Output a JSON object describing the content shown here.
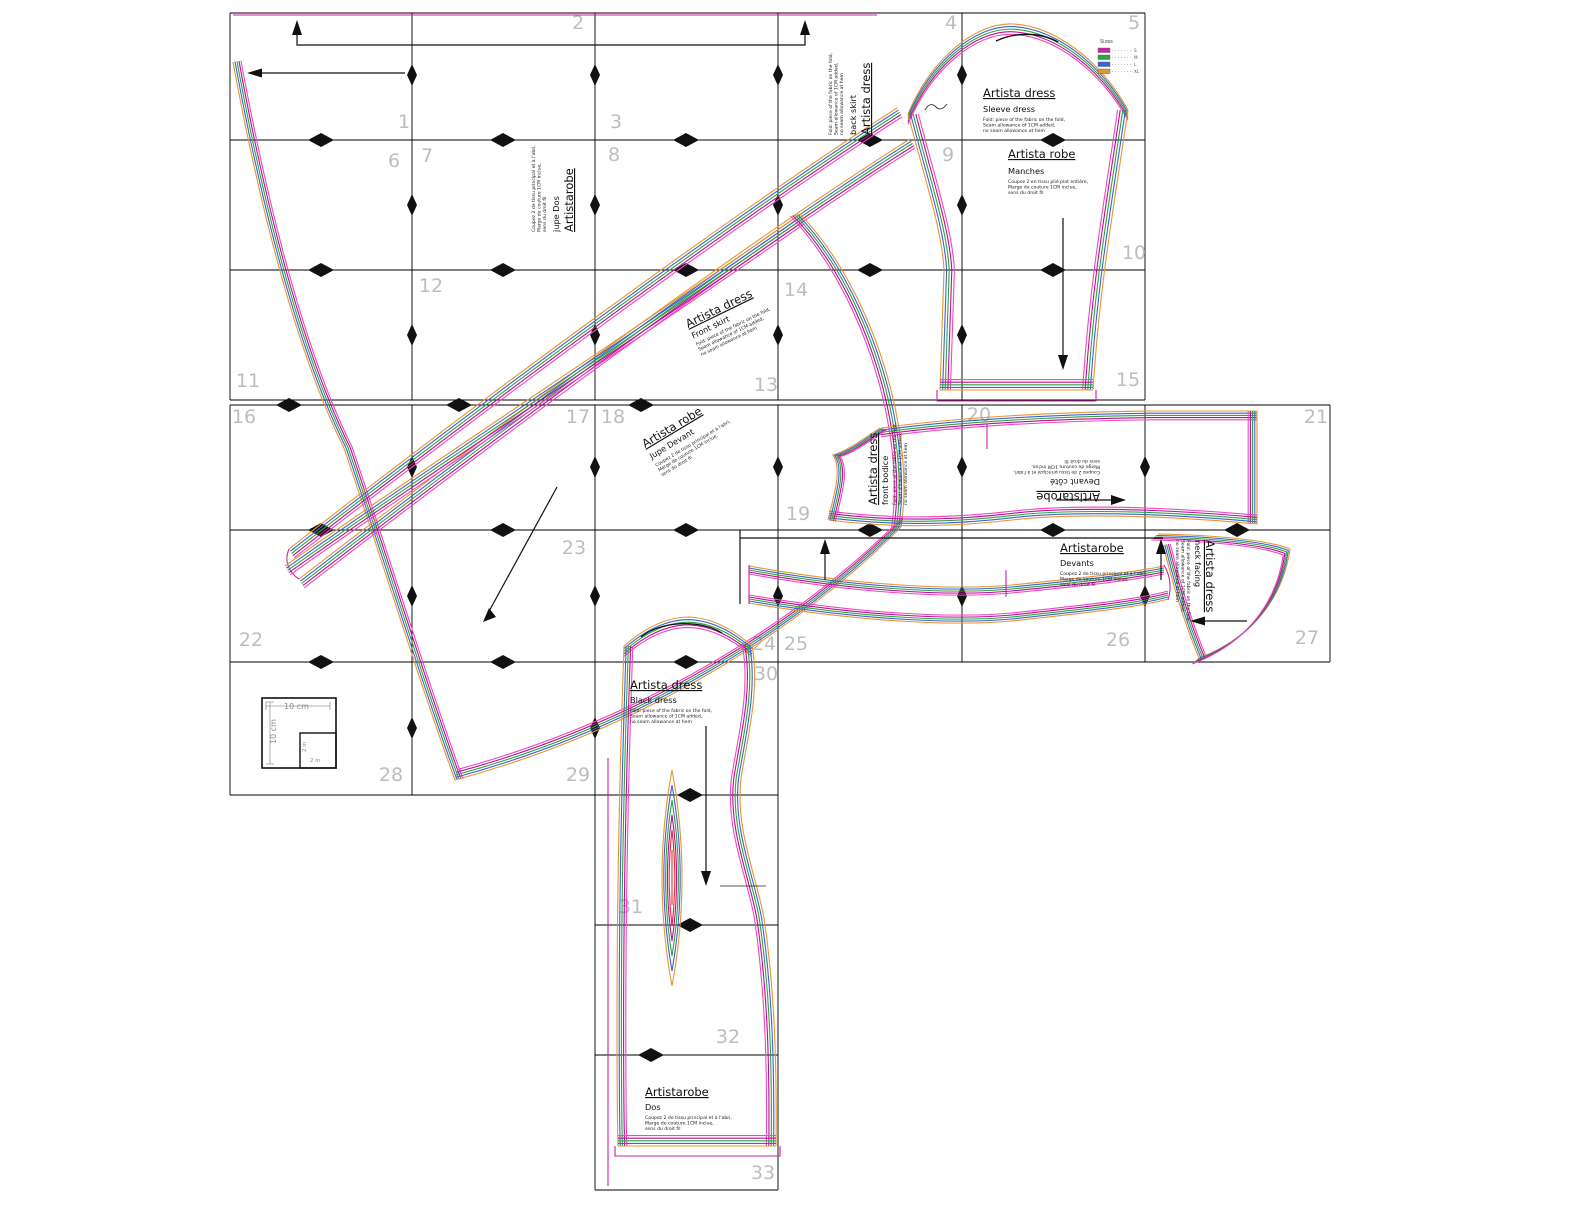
{
  "colors": {
    "bundle": [
      "#e8952f",
      "#3a64cf",
      "#2fa43c",
      "#b80f96",
      "#ee49c0"
    ],
    "sizes": [
      "#cf1fa5",
      "#2fa43c",
      "#3a64cf",
      "#e8952f"
    ],
    "magenta": "#cf1fa5",
    "accent_red": "#d93030",
    "grid": "#000000",
    "page_number": "#bdbdbd"
  },
  "page_numbers": [
    "1",
    "2",
    "3",
    "4",
    "5",
    "6",
    "7",
    "8",
    "9",
    "10",
    "11",
    "12",
    "13",
    "14",
    "15",
    "16",
    "17",
    "18",
    "19",
    "20",
    "21",
    "22",
    "23",
    "24",
    "25",
    "26",
    "27",
    "28",
    "29",
    "30",
    "31",
    "32",
    "33"
  ],
  "legend": {
    "title": "Sizes",
    "items": [
      {
        "label": "S"
      },
      {
        "label": "M"
      },
      {
        "label": "L"
      },
      {
        "label": "XL"
      }
    ]
  },
  "scale_box": {
    "width_label": "10 cm",
    "height_label": "10 cm",
    "inner_width_label": "2 in",
    "inner_height_label": "2 in"
  },
  "blocks": {
    "sleeve": {
      "header": "Artista dress",
      "sub": "Sleeve dress",
      "lines": [
        "Fold: piece of the fabric on the fold,",
        "Seam allowance of 1CM added,",
        "no seam allowance at hem"
      ]
    },
    "manches": {
      "header": "Artista robe",
      "sub": "Manches",
      "lines": [
        "Coupez 2 en tissu plié plat entière,",
        "Marge de couture 1CM inclue,",
        "sens du droit fil"
      ]
    },
    "back_skirt": {
      "header": "Artista dress",
      "sub": "back skirt",
      "lines": [
        "Fold: piece of the fabric on the fold,",
        "Seam allowance of 1CM added,",
        "no seam allowance at hem"
      ]
    },
    "jupe_dos": {
      "header": "Artistarobe",
      "sub": "jupe Dos",
      "lines": [
        "Coupez 2 de tissu principal et à l'abri,",
        "Marge de couture 1CM inclue,",
        "sens du droit fil"
      ]
    },
    "sash": {
      "header": "Artista dress",
      "sub": "Front skirt",
      "lines": [
        "Fold: piece of the fabric on the fold,",
        "Seam allowance of 1CM added,",
        "no seam allowance at hem"
      ]
    },
    "jupe_devant": {
      "header": "Artista robe",
      "sub": "Jupe Devant",
      "lines": [
        "Coupez 2 de tissu principal et à l'abri,",
        "Marge de couture 1CM inclue,",
        "sens du droit fil"
      ]
    },
    "bodice": {
      "header": "Artista dress",
      "sub": "front bodice",
      "lines": [
        "Fold: piece of the fabric on the fold,",
        "Seam allowance of 1CM added,",
        "no seam allowance at hem"
      ]
    },
    "bodice_flip": {
      "header": "Artistarobe",
      "sub": "Devant côté",
      "lines": [
        "Coupez 2 de tissu principal et à l'abri,",
        "Marge de couture 1CM inclue,",
        "sens du droit fil"
      ]
    },
    "devants": {
      "header": "Artistarobe",
      "sub": "Devants",
      "lines": [
        "Coupez 2 de tissu principal et à l'abri,",
        "Marge de couture 1CM inclue,",
        "sens du droit fil"
      ]
    },
    "facing": {
      "header": "Artista dress",
      "sub": "neck facing",
      "lines": [
        "Fold: piece of the fabric on the fold,",
        "Seam allowance of 1CM added,",
        "no seam allowance at hem"
      ]
    },
    "black_dress": {
      "header": "Artista dress",
      "sub": "Black dress",
      "lines": [
        "Fold: piece of the fabric on the fold,",
        "Seam allowance of 1CM added,",
        "no seam allowance at hem"
      ]
    },
    "dos": {
      "header": "Artistarobe",
      "sub": "Dos",
      "lines": [
        "Coupez 2 de tissu principal et à l'abri,",
        "Marge de couture 1CM inclue,",
        "sens du droit fil"
      ]
    }
  }
}
